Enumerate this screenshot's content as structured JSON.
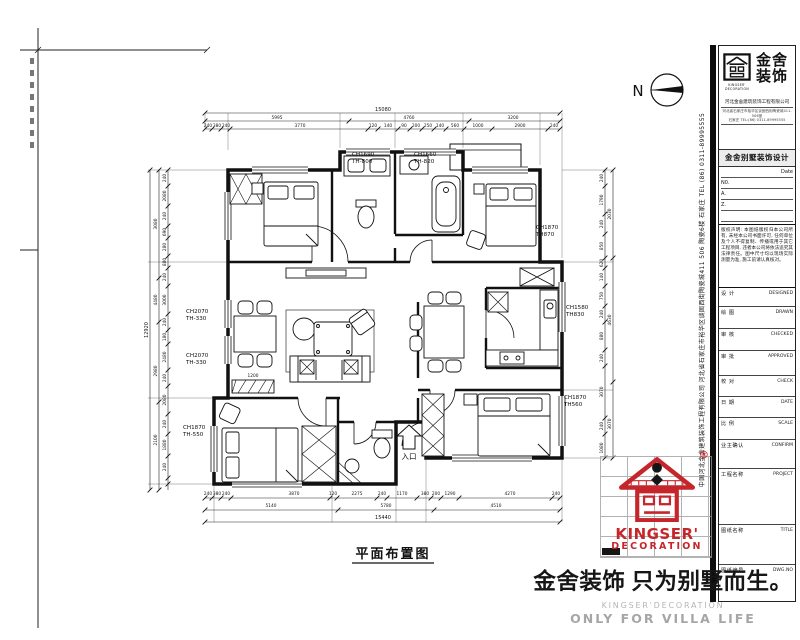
{
  "north": {
    "label": "N"
  },
  "plan": {
    "title": "平面布置图",
    "entry_label": "入口",
    "ch_labels": [
      {
        "x": 352,
        "y": 156,
        "l1": "CH1690",
        "l2": "TH-800"
      },
      {
        "x": 414,
        "y": 156,
        "l1": "CH1660",
        "l2": "TH-820"
      },
      {
        "x": 536,
        "y": 229,
        "l1": "CH1870",
        "l2": "TH870"
      },
      {
        "x": 566,
        "y": 309,
        "l1": "CH1580",
        "l2": "TH830"
      },
      {
        "x": 564,
        "y": 399,
        "l1": "CH1870",
        "l2": "TH560"
      },
      {
        "x": 186,
        "y": 313,
        "l1": "CH2070",
        "l2": "TH-330"
      },
      {
        "x": 186,
        "y": 357,
        "l1": "CH2070",
        "l2": "TH-330"
      },
      {
        "x": 183,
        "y": 429,
        "l1": "CH1870",
        "l2": "TH-550"
      }
    ],
    "dims_top": [
      {
        "x": 383,
        "y": 111,
        "t": "15080"
      },
      {
        "x": 277,
        "y": 119,
        "t": "5995"
      },
      {
        "x": 409,
        "y": 119,
        "t": "4760"
      },
      {
        "x": 513,
        "y": 119,
        "t": "3200"
      },
      {
        "x": 208,
        "y": 127,
        "t": "240"
      },
      {
        "x": 217,
        "y": 127,
        "t": "380"
      },
      {
        "x": 226,
        "y": 127,
        "t": "240"
      },
      {
        "x": 300,
        "y": 127,
        "t": "3770"
      },
      {
        "x": 373,
        "y": 127,
        "t": "120"
      },
      {
        "x": 388,
        "y": 127,
        "t": "140"
      },
      {
        "x": 404,
        "y": 127,
        "t": "90"
      },
      {
        "x": 416,
        "y": 127,
        "t": "200"
      },
      {
        "x": 428,
        "y": 127,
        "t": "250"
      },
      {
        "x": 440,
        "y": 127,
        "t": "140"
      },
      {
        "x": 455,
        "y": 127,
        "t": "560"
      },
      {
        "x": 478,
        "y": 127,
        "t": "1000"
      },
      {
        "x": 520,
        "y": 127,
        "t": "2900"
      },
      {
        "x": 554,
        "y": 127,
        "t": "240"
      }
    ],
    "dims_bottom": [
      {
        "x": 208,
        "y": 495,
        "t": "240"
      },
      {
        "x": 217,
        "y": 495,
        "t": "380"
      },
      {
        "x": 226,
        "y": 495,
        "t": "240"
      },
      {
        "x": 294,
        "y": 495,
        "t": "3870"
      },
      {
        "x": 333,
        "y": 495,
        "t": "120"
      },
      {
        "x": 357,
        "y": 495,
        "t": "2275"
      },
      {
        "x": 382,
        "y": 495,
        "t": "240"
      },
      {
        "x": 402,
        "y": 495,
        "t": "1170"
      },
      {
        "x": 425,
        "y": 495,
        "t": "380"
      },
      {
        "x": 436,
        "y": 495,
        "t": "200"
      },
      {
        "x": 450,
        "y": 495,
        "t": "1290"
      },
      {
        "x": 510,
        "y": 495,
        "t": "4270"
      },
      {
        "x": 556,
        "y": 495,
        "t": "240"
      },
      {
        "x": 271,
        "y": 507,
        "t": "5140"
      },
      {
        "x": 386,
        "y": 507,
        "t": "5780"
      },
      {
        "x": 496,
        "y": 507,
        "t": "4510"
      },
      {
        "x": 383,
        "y": 519,
        "t": "15440"
      }
    ],
    "dims_left": [
      {
        "x": 148,
        "y": 330,
        "t": "12920"
      },
      {
        "x": 157,
        "y": 224,
        "t": "3080"
      },
      {
        "x": 157,
        "y": 300,
        "t": "4480"
      },
      {
        "x": 157,
        "y": 371,
        "t": "2980"
      },
      {
        "x": 157,
        "y": 440,
        "t": "2100"
      },
      {
        "x": 166,
        "y": 178,
        "t": "240"
      },
      {
        "x": 166,
        "y": 196,
        "t": "2080"
      },
      {
        "x": 166,
        "y": 216,
        "t": "240"
      },
      {
        "x": 166,
        "y": 232,
        "t": "690"
      },
      {
        "x": 166,
        "y": 247,
        "t": "280"
      },
      {
        "x": 166,
        "y": 262,
        "t": "880"
      },
      {
        "x": 166,
        "y": 277,
        "t": "240"
      },
      {
        "x": 166,
        "y": 300,
        "t": "3000"
      },
      {
        "x": 166,
        "y": 322,
        "t": "240"
      },
      {
        "x": 166,
        "y": 337,
        "t": "180"
      },
      {
        "x": 166,
        "y": 357,
        "t": "2480"
      },
      {
        "x": 166,
        "y": 378,
        "t": "240"
      },
      {
        "x": 166,
        "y": 400,
        "t": "2080"
      },
      {
        "x": 166,
        "y": 424,
        "t": "240"
      },
      {
        "x": 166,
        "y": 445,
        "t": "1880"
      },
      {
        "x": 166,
        "y": 467,
        "t": "240"
      }
    ],
    "dims_right": [
      {
        "x": 603,
        "y": 178,
        "t": "240"
      },
      {
        "x": 603,
        "y": 200,
        "t": "1790"
      },
      {
        "x": 603,
        "y": 224,
        "t": "240"
      },
      {
        "x": 603,
        "y": 246,
        "t": "850"
      },
      {
        "x": 603,
        "y": 263,
        "t": "620"
      },
      {
        "x": 603,
        "y": 277,
        "t": "140"
      },
      {
        "x": 603,
        "y": 296,
        "t": "750"
      },
      {
        "x": 603,
        "y": 314,
        "t": "240"
      },
      {
        "x": 603,
        "y": 336,
        "t": "880"
      },
      {
        "x": 603,
        "y": 358,
        "t": "240"
      },
      {
        "x": 603,
        "y": 392,
        "t": "3070"
      },
      {
        "x": 603,
        "y": 426,
        "t": "240"
      },
      {
        "x": 603,
        "y": 448,
        "t": "1080"
      },
      {
        "x": 611,
        "y": 214,
        "t": "2030"
      },
      {
        "x": 611,
        "y": 320,
        "t": "4630"
      },
      {
        "x": 611,
        "y": 424,
        "t": "3070"
      }
    ],
    "dims_inline": [
      {
        "x": 253,
        "y": 377,
        "t": "1200"
      }
    ]
  },
  "titleblock": {
    "logo_cn_line1": "金舍",
    "logo_cn_line2": "装饰",
    "logo_en_line1": "KINGSER'",
    "logo_en_line2": "DECORATION",
    "company": "河北金舍建筑装饰工程有限公司",
    "address1": "河北省石家庄市裕华区谈固西街陶瓷城411-506室",
    "address2": "石家庄 TEL:(86) 0311-89995555",
    "band": "金舍别墅装饰设计",
    "date_label": "Date",
    "no_label": "N0.",
    "a_label": "A.",
    "z_label": "Z.",
    "notice": "版权声明: 本图纸版权归本公司所有, 未经本公司书面许可, 任何单位及个人不得复制、传播或用于其它工程项目, 违者本公司将依法追究其法律责任。图中尺寸均以现场实际测量为准, 施工前请认真核对。",
    "fields": [
      {
        "cn": "设 计",
        "en": "DESIGNED",
        "h": 19
      },
      {
        "cn": "绘 图",
        "en": "DRAWN",
        "h": 22
      },
      {
        "cn": "审 核",
        "en": "CHECKED",
        "h": 22
      },
      {
        "cn": "审 批",
        "en": "APPROVED",
        "h": 25
      },
      {
        "cn": "校 对",
        "en": "CHECK",
        "h": 21
      },
      {
        "cn": "日 期",
        "en": "DATE",
        "h": 21
      },
      {
        "cn": "比 例",
        "en": "SCALE",
        "h": 22
      },
      {
        "cn": "业主确认",
        "en": "CONFIRM",
        "h": 29
      },
      {
        "cn": "工程名称",
        "en": "PROJECT",
        "h": 56
      },
      {
        "cn": "图纸名称",
        "en": "TITLE",
        "h": 40
      },
      {
        "cn": "图纸编号",
        "en": "DWG.NO",
        "h": 26
      }
    ]
  },
  "strip": {
    "text": "中国河北金舍建筑装饰工程有限公司  河北省石家庄市裕华区谈固西街陶瓷城411 506 陶瓷6楼  石家庄  TEL (86) 0311-89995555"
  },
  "stamp": {
    "reg": "®",
    "en1": "KINGSER'",
    "en2": "DECORATION"
  },
  "slogan": {
    "cn": "金舍装饰 只为别墅而生。",
    "en1": "KINGSER'DECORATION",
    "en2": "ONLY FOR VILLA LIFE"
  }
}
